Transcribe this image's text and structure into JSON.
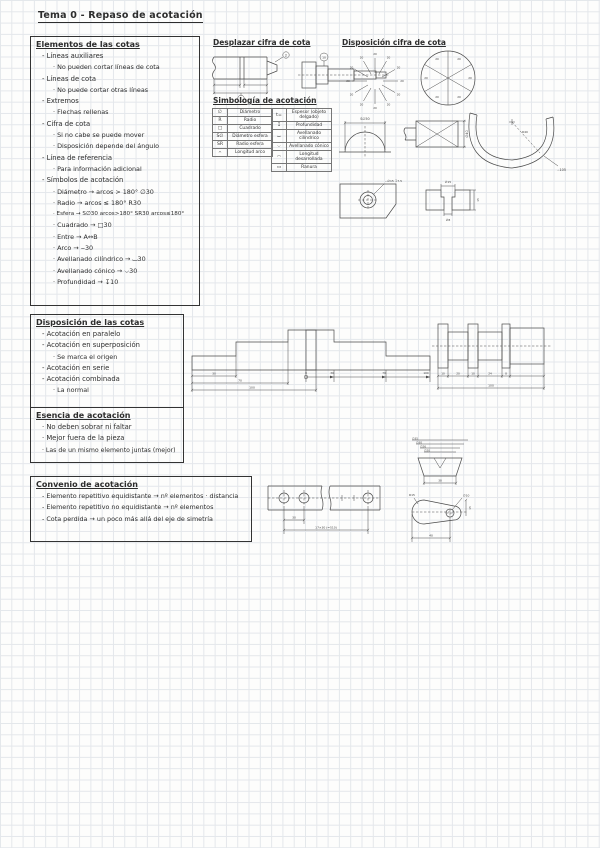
{
  "page": {
    "title": "Tema 0 - Repaso de acotación"
  },
  "colors": {
    "ink": "#2d2d2d",
    "grid": "#e4e7eb",
    "paper": "#fdfdfc"
  },
  "headings": {
    "desplazar": "Desplazar cifra de cota",
    "disposicion_cifra": "Disposición cifra de cota",
    "simbologia": "Simbología de acotación"
  },
  "boxes": {
    "elementos": {
      "title": "Elementos de las cotas",
      "items": [
        {
          "level": 1,
          "text": "- Líneas auxiliares"
        },
        {
          "level": 2,
          "text": "· No pueden cortar líneas de cota"
        },
        {
          "level": 1,
          "text": "- Líneas de cota"
        },
        {
          "level": 2,
          "text": "· No puede cortar otras líneas"
        },
        {
          "level": 1,
          "text": "- Extremos"
        },
        {
          "level": 2,
          "text": "· Flechas rellenas"
        },
        {
          "level": 1,
          "text": "- Cifra de cota"
        },
        {
          "level": 2,
          "text": "· Si no cabe se puede mover"
        },
        {
          "level": 2,
          "text": "· Disposición depende del ángulo"
        },
        {
          "level": 1,
          "text": "- Línea de referencia"
        },
        {
          "level": 2,
          "text": "· Para información adicional"
        },
        {
          "level": 1,
          "text": "- Símbolos de acotación"
        },
        {
          "level": 2,
          "text": "· Diámetro → arcos > 180°  ∅30"
        },
        {
          "level": 2,
          "text": "· Radio → arcos ≤ 180°  R30"
        },
        {
          "level": 2,
          "text": "· Esfera → S∅30 arcos>180°  SR30 arcos≤180°"
        },
        {
          "level": 2,
          "text": "· Cuadrado → □30"
        },
        {
          "level": 2,
          "text": "· Entre → A↔B"
        },
        {
          "level": 2,
          "text": "· Arco → ⌢30"
        },
        {
          "level": 2,
          "text": "· Avellanado cilíndrico → ⌴30"
        },
        {
          "level": 2,
          "text": "· Avellanado cónico → ⌵30"
        },
        {
          "level": 2,
          "text": "· Profundidad → ↧10"
        }
      ]
    },
    "disposicion": {
      "title": "Disposición de las cotas",
      "items": [
        {
          "level": 1,
          "text": "- Acotación en paralelo"
        },
        {
          "level": 1,
          "text": "- Acotación en superposición"
        },
        {
          "level": 2,
          "text": "· Se marca el origen"
        },
        {
          "level": 1,
          "text": "- Acotación en serie"
        },
        {
          "level": 1,
          "text": "- Acotación combinada"
        },
        {
          "level": 2,
          "text": "· La normal"
        }
      ]
    },
    "esencia": {
      "title": "Esencia de acotación",
      "items": [
        {
          "level": 1,
          "text": "· No deben sobrar ni faltar"
        },
        {
          "level": 1,
          "text": "· Mejor fuera de la pieza"
        },
        {
          "level": 1,
          "text": "· Las de un mismo elemento juntas (mejor)"
        }
      ]
    },
    "convenio": {
      "title": "Convenio de acotación",
      "items": [
        {
          "level": 1,
          "text": "- Elemento repetitivo equidistante → nº elementos · distancia"
        },
        {
          "level": 1,
          "text": "- Elemento repetitivo no equidistante → nº elementos"
        },
        {
          "level": 1,
          "text": "- Cota perdida → un poco más allá del eje de simetría"
        }
      ]
    }
  },
  "tables": {
    "left": {
      "rows": [
        [
          "∅",
          "Diámetro"
        ],
        [
          "R",
          "Radio"
        ],
        [
          "□",
          "Cuadrado"
        ],
        [
          "S∅",
          "Diámetro esfera"
        ],
        [
          "SR",
          "Radio esfera"
        ],
        [
          "⌢",
          "Longitud arco"
        ]
      ]
    },
    "right": {
      "rows": [
        [
          "t=",
          "Espesor (objeto delgado)"
        ],
        [
          "↧",
          "Profundidad"
        ],
        [
          "⌴",
          "Avellanado cilíndrico"
        ],
        [
          "⌵",
          "Avellanado cónico"
        ],
        [
          "◠",
          "Longitud desarrollada"
        ],
        [
          "▭",
          "Ranura"
        ]
      ]
    }
  },
  "sk": {
    "shaft1": {
      "c1": "1",
      "c2": "2"
    },
    "shaft2": {
      "c1": "10"
    },
    "star": {
      "label": "20"
    },
    "pie": {
      "label": "20"
    },
    "dome": {
      "label": "S∅50"
    },
    "flat": {
      "label": "∅40"
    },
    "hook": {
      "label": "⌢105",
      "r": "R40"
    },
    "cbore": {
      "leader": "⌴∅15 ↧7.5",
      "top": "∅15",
      "d1": "∅8",
      "d2": "15"
    },
    "par": {
      "d1": "30",
      "d2": "70",
      "d3": "100"
    },
    "sup": {
      "o": "0",
      "d1": "30",
      "d2": "70",
      "d3": "100"
    },
    "chain": {
      "dims": [
        "10",
        "20",
        "10",
        "24",
        "8"
      ],
      "total": "100"
    },
    "strip": {
      "d1": "30",
      "total": "17×30 (=510)"
    },
    "stack": {
      "dims": [
        "∅35",
        "∅30",
        "∅26",
        "∅20"
      ],
      "w": "38"
    },
    "bracket": {
      "r": "R15",
      "hole": "∅10",
      "d1": "40",
      "d2": "15"
    }
  }
}
